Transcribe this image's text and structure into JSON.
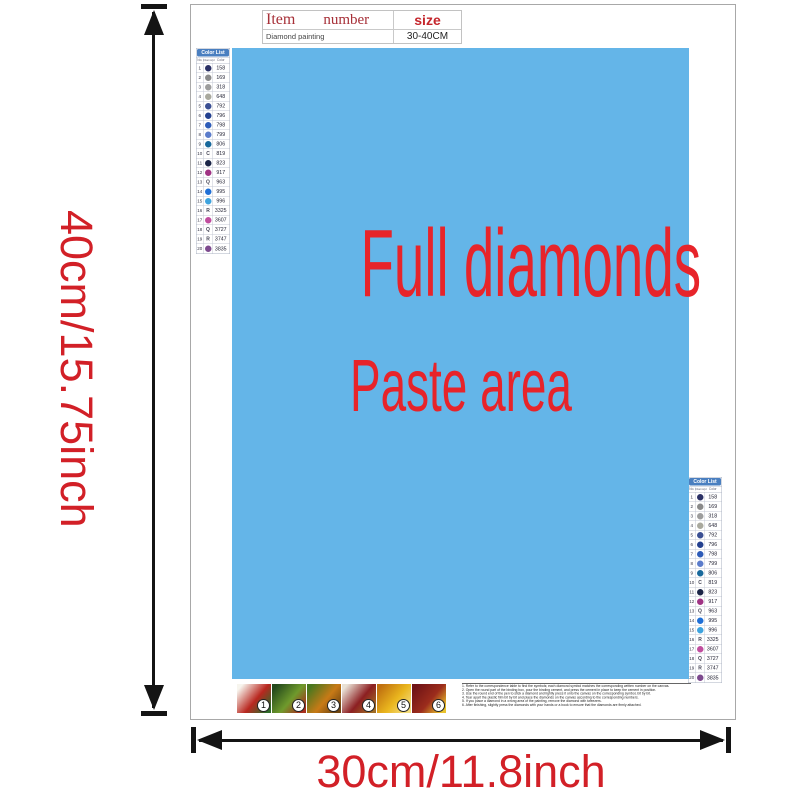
{
  "dimensions": {
    "height_label": "40cm/15.75inch",
    "width_label": "30cm/11.8inch",
    "arrow_color": "#141414",
    "label_color": "#d22027"
  },
  "item_table": {
    "col_item": "Item",
    "col_number": "number",
    "col_size": "size",
    "row_item": "Diamond painting",
    "row_number": "",
    "row_size": "30-40CM",
    "header_color": "#a73038",
    "size_color": "#c5262c"
  },
  "paste_area": {
    "line1": "Full diamonds",
    "line2": "Paste area",
    "bg_color": "#64b5e8",
    "text_color": "#e7242a"
  },
  "color_list": {
    "title": "Color List",
    "header_bg": "#4a7fc0",
    "columns": [
      "No.",
      "Diamond",
      "Color"
    ],
    "rows": [
      {
        "no": "1",
        "sym": "",
        "code": "158",
        "circle": "#2b3166"
      },
      {
        "no": "2",
        "sym": "",
        "code": "169",
        "circle": "#8a8a8a"
      },
      {
        "no": "3",
        "sym": "",
        "code": "318",
        "circle": "#9d9d9d"
      },
      {
        "no": "4",
        "sym": "",
        "code": "648",
        "circle": "#a9a99e"
      },
      {
        "no": "5",
        "sym": "",
        "code": "792",
        "circle": "#3a4f93"
      },
      {
        "no": "6",
        "sym": "",
        "code": "796",
        "circle": "#23408f"
      },
      {
        "no": "7",
        "sym": "",
        "code": "798",
        "circle": "#2e5cb8"
      },
      {
        "no": "8",
        "sym": "",
        "code": "799",
        "circle": "#5b7ccb"
      },
      {
        "no": "9",
        "sym": "",
        "code": "806",
        "circle": "#18699c"
      },
      {
        "no": "10",
        "sym": "C",
        "code": "819",
        "circle": ""
      },
      {
        "no": "11",
        "sym": "",
        "code": "823",
        "circle": "#1b2547"
      },
      {
        "no": "12",
        "sym": "",
        "code": "917",
        "circle": "#a03384"
      },
      {
        "no": "13",
        "sym": "Q",
        "code": "963",
        "circle": ""
      },
      {
        "no": "14",
        "sym": "",
        "code": "995",
        "circle": "#1f6fd6"
      },
      {
        "no": "15",
        "sym": "",
        "code": "996",
        "circle": "#3fa3de"
      },
      {
        "no": "16",
        "sym": "R",
        "code": "3325",
        "circle": ""
      },
      {
        "no": "17",
        "sym": "",
        "code": "3607",
        "circle": "#c04d9e"
      },
      {
        "no": "18",
        "sym": "Q",
        "code": "3727",
        "circle": ""
      },
      {
        "no": "19",
        "sym": "R",
        "code": "3747",
        "circle": ""
      },
      {
        "no": "20",
        "sym": "",
        "code": "3835",
        "circle": "#7d4a8e"
      }
    ]
  },
  "steps": {
    "items": [
      {
        "num": "1",
        "colors": [
          "#f7f5ee",
          "#b9271f",
          "#2f6b2a"
        ]
      },
      {
        "num": "2",
        "colors": [
          "#24491c",
          "#6f9a2c",
          "#a8301e"
        ]
      },
      {
        "num": "3",
        "colors": [
          "#48771f",
          "#c87a16",
          "#6e4410"
        ]
      },
      {
        "num": "4",
        "colors": [
          "#e9e2d6",
          "#8c1f22",
          "#a06c24"
        ]
      },
      {
        "num": "5",
        "colors": [
          "#c07110",
          "#eab61e",
          "#f3dc7c"
        ]
      },
      {
        "num": "6",
        "colors": [
          "#701416",
          "#9c2c1c",
          "#e9c22c"
        ]
      }
    ]
  },
  "instructions": {
    "lines": [
      "1. Refer to the correspondence table to find the symbols; each diamond symbol matches the corresponding written number on the canvas.",
      "2. Open the round part of the binding box, pour the binding cement, and press the cement in place to keep the cement in position.",
      "3. Use the round end of the pen to stick a diamond and lightly press it onto the canvas on the corresponding symbol, bit by bit.",
      "4. Tear apart the plastic film bit by bit and place the diamonds on the canvas according to the corresponding numbers.",
      "5. If you place a diamond in a wrong area of the painting, remove the diamond with tweezers.",
      "6. After finishing, slightly press the diamonds with your hands or a book to ensure that the diamonds are firmly attached."
    ]
  }
}
